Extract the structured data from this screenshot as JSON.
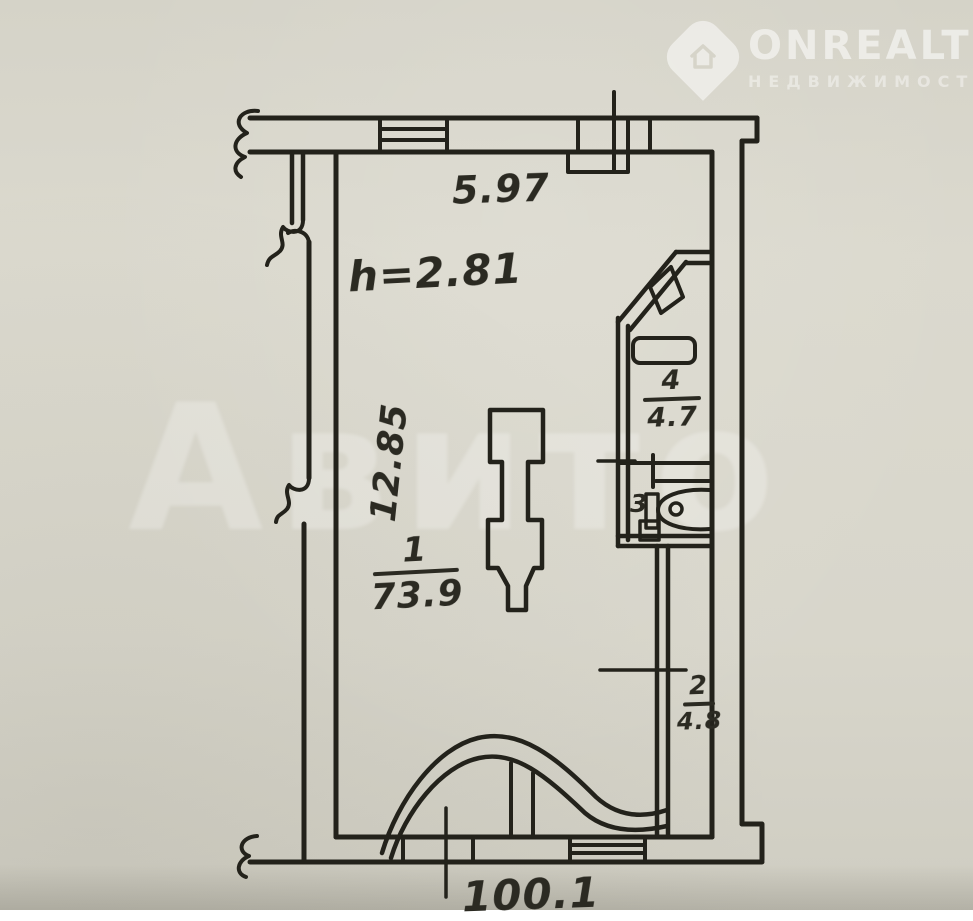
{
  "watermark_corner": {
    "brand": "ONREALT",
    "subtitle": "НЕДВИЖИМОСТЬ"
  },
  "watermark_center": {
    "text": "Авито"
  },
  "plan": {
    "top_width": "5.97",
    "ceiling_height": "h=2.81",
    "side_height": "12.85",
    "bottom_length": "100.1",
    "rooms": [
      {
        "number": "1",
        "area": "73.9"
      },
      {
        "number": "2",
        "area": "4.8"
      },
      {
        "number": "3"
      },
      {
        "number": "4",
        "area": "4.7"
      }
    ]
  },
  "colors": {
    "paper": "#d8d6cb",
    "ink": "#23221b",
    "watermark": "#ffffff"
  }
}
